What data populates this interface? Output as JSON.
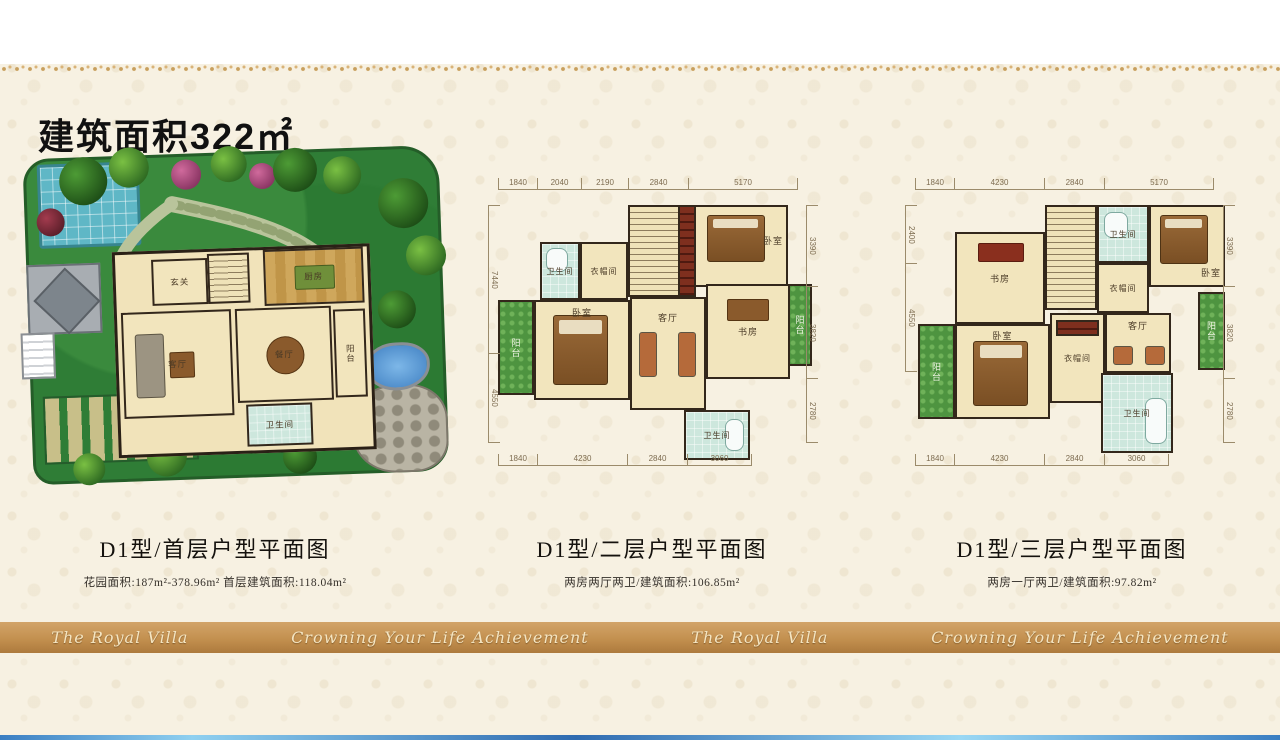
{
  "page": {
    "title": "建筑面积322㎡",
    "banner": [
      "The Royal Villa",
      "Crowning Your Life Achievement",
      "The Royal Villa",
      "Crowning Your Life Achievement"
    ]
  },
  "plan_first": {
    "caption": "D1型/首层户型平面图",
    "subcaption": "花园面积:187m²-378.96m²  首层建筑面积:118.04m²",
    "rooms": {
      "entry": "玄关",
      "kitchen": "厨房",
      "living": "客厅",
      "dining": "餐厅",
      "balcony": "阳台",
      "bath": "卫生间"
    }
  },
  "plan_second": {
    "caption": "D1型/二层户型平面图",
    "subcaption": "两房两厅两卫/建筑面积:106.85m²",
    "rooms": {
      "bath_top": "卫生间",
      "cloak": "衣帽间",
      "bedroom_top": "卧室",
      "balcony_left": "阳台",
      "bedroom_main": "卧室",
      "living": "客厅",
      "study": "书房",
      "balcony_right": "阳台",
      "bath_bottom": "卫生间"
    },
    "dims": {
      "top": [
        "1840",
        "2040",
        "2190",
        "2840",
        "5170"
      ],
      "bottom": [
        "1840",
        "4230",
        "2840",
        "3060"
      ],
      "left": [
        "7440",
        "4550"
      ],
      "right": [
        "3390",
        "3820",
        "2780"
      ]
    }
  },
  "plan_third": {
    "caption": "D1型/三层户型平面图",
    "subcaption": "两房一厅两卫/建筑面积:97.82m²",
    "rooms": {
      "study": "书房",
      "bath_top": "卫生间",
      "cloak_top": "衣帽间",
      "bedroom_top": "卧室",
      "balcony_left": "阳台",
      "bedroom_main": "卧室",
      "cloak_bottom": "衣帽间",
      "living": "客厅",
      "balcony_right": "阳台",
      "bath_bottom": "卫生间"
    },
    "dims": {
      "top": [
        "1840",
        "4230",
        "2840",
        "5170"
      ],
      "bottom": [
        "1840",
        "4230",
        "2840",
        "3060"
      ],
      "left": [
        "2400",
        "4550"
      ],
      "right": [
        "3390",
        "3820",
        "2780"
      ]
    }
  }
}
